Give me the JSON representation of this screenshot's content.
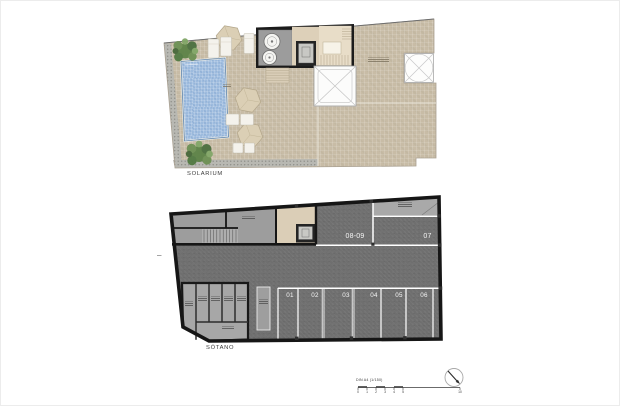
{
  "solarium": {
    "label": "SOLARIUM",
    "fixtures": [
      "pool",
      "palm-plant",
      "parasol",
      "sun-lounger",
      "side-table",
      "machine-room-tanks",
      "elevator",
      "staircase",
      "exterior-staircase",
      "skylight-x",
      "skylight-circle-x"
    ],
    "colors": {
      "deck": "#c8bca6",
      "pool_water": "#9dbbde",
      "pool_edge": "#5b82ab",
      "walkway": "#b8b8b2",
      "machine_room_floor": "#9c9c9c",
      "stair_floor": "#e8ddc8",
      "lobby": "#ddd0b9",
      "plant_green": "#5d8348",
      "parasol": "#dbcfb5",
      "wall": "#1b1b1b"
    }
  },
  "basement": {
    "label": "SÓTANO",
    "stalls_bottom": [
      "01",
      "02",
      "03",
      "04",
      "05",
      "06"
    ],
    "stalls_top": [
      "08-09",
      "07"
    ],
    "colors": {
      "floor": "#6f6f6f",
      "stair_room": "#9d9d9d",
      "storage_room": "#a7a7a7",
      "vestibule": "#dbceb7",
      "wall": "#161616",
      "stall_line": "#ffffff",
      "stall_number": "#f0f0f0",
      "elevator": "#242424"
    }
  },
  "footer": {
    "scale_title": "DIN A4 (1/150)",
    "scale_ticks": [
      "0",
      "1",
      "2",
      "3",
      "4",
      "5",
      "10"
    ],
    "north_arrow_icon": "north-arrow-icon"
  }
}
